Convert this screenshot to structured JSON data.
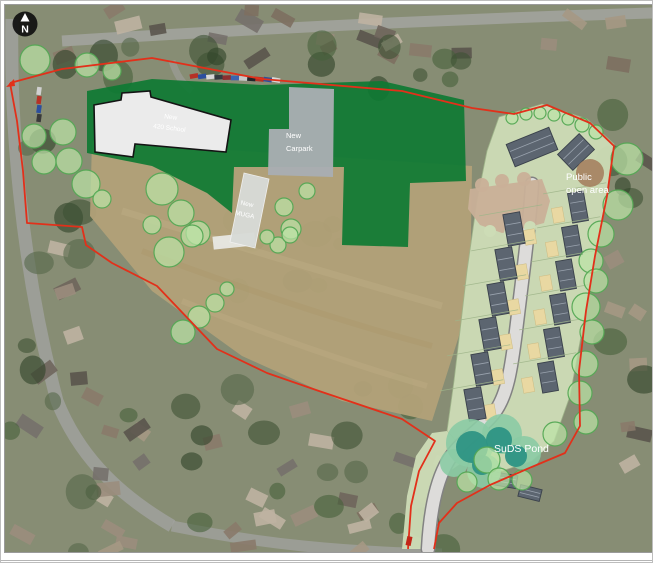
{
  "north_marker": {
    "label": "N"
  },
  "labels": [
    {
      "id": "school-label",
      "lines": [
        "New",
        "420 School"
      ]
    },
    {
      "id": "carpark-label",
      "lines": [
        "New",
        "Carpark"
      ]
    },
    {
      "id": "muga-label",
      "lines": [
        "New",
        "MUGA"
      ]
    },
    {
      "id": "open-area-label",
      "lines": [
        "Public",
        "open area"
      ]
    },
    {
      "id": "pond-label",
      "lines": [
        "SuDS Pond"
      ]
    }
  ],
  "colors": {
    "boundary_red": "#e2301a",
    "playing_field_green": "#0e7a33",
    "tree_fill": "#bce4a6",
    "tree_stroke": "#54a854",
    "housing_parcel": "#cddcb6",
    "road_fill": "#dddcda",
    "road_edge": "#828282",
    "court_tan": "#c9b098",
    "roof_grey": "#5c6570",
    "roof_line": "#9aa3ae",
    "garden_tan": "#e9d8a2",
    "pond_outer": "#8bcba4",
    "pond_inner": "#2e9484",
    "school_fill": "#ebebeb",
    "school_stroke": "#141414",
    "carpark_grey": "#a9aeb2",
    "muga_grey": "#d8dbd7",
    "open_area_patch": "#a5815f",
    "aerial_base": "#878d74",
    "field_tan": "#b2a178",
    "label_text": "#ffffff"
  },
  "site_plan": {
    "playing_field_polygon": "85,90 150,78 260,84 380,80 462,99 464,180 408,182 406,246 340,244 342,166 232,166 230,212 205,192 150,165 85,152",
    "school_polygon": "92,104 119,99 120,92 148,90 149,96 229,119 224,151 133,143 131,156 93,151",
    "carpark_polygon": "287,86 332,88 331,176 266,174 267,128 287,128",
    "muga_polygon": "242,172 267,178 253,247 228,241",
    "pavilion": [
      232,
      240,
      42,
      13,
      -6
    ],
    "field_polygon": "90,140 470,165 468,300 430,420 340,400 240,355 150,290 88,215",
    "housing_parcel_polygon": "497,116 540,103 585,118 612,143 605,192 592,260 580,330 568,395 552,440 530,460 500,470 468,456 445,430 452,380 458,330 465,270 475,200 485,150",
    "access_verge_polygon": "445,430 468,456 448,470 438,500 433,548 400,548 405,495 414,455 430,432",
    "road_path": "M 530 183 C 528 220 520 280 514 330 C 509 370 505 395 492 412 C 478 430 458 440 446 460 C 434 480 428 510 426 548",
    "court_polygon": "468,188 540,178 548,200 542,222 520,228 500,232 478,224 466,208",
    "court_bumps": [
      [
        480,
        184,
        7
      ],
      [
        500,
        180,
        7
      ],
      [
        522,
        178,
        7
      ]
    ],
    "court_punches": [
      [
        488,
        230,
        6
      ],
      [
        508,
        232,
        6
      ],
      [
        528,
        226,
        6
      ]
    ],
    "houses": [
      [
        530,
        146,
        46,
        24,
        -22
      ],
      [
        574,
        151,
        30,
        22,
        -44
      ],
      [
        512,
        228,
        17,
        32,
        -10
      ],
      [
        504,
        263,
        17,
        32,
        -10
      ],
      [
        496,
        298,
        17,
        32,
        -10
      ],
      [
        488,
        333,
        17,
        32,
        -10
      ],
      [
        480,
        368,
        17,
        32,
        -10
      ],
      [
        473,
        403,
        17,
        32,
        -10
      ],
      [
        576,
        206,
        16,
        30,
        -10
      ],
      [
        570,
        240,
        16,
        30,
        -10
      ],
      [
        564,
        274,
        16,
        30,
        -10
      ],
      [
        558,
        308,
        16,
        30,
        -10
      ],
      [
        552,
        342,
        16,
        30,
        -10
      ],
      [
        546,
        376,
        16,
        30,
        -10
      ],
      [
        502,
        479,
        26,
        13,
        10
      ],
      [
        528,
        492,
        22,
        12,
        14
      ]
    ],
    "gardens": [
      [
        528,
        236
      ],
      [
        520,
        271
      ],
      [
        512,
        306
      ],
      [
        504,
        341
      ],
      [
        496,
        376
      ],
      [
        488,
        411
      ],
      [
        556,
        214
      ],
      [
        550,
        248
      ],
      [
        544,
        282
      ],
      [
        538,
        316
      ],
      [
        532,
        350
      ],
      [
        526,
        384
      ]
    ],
    "trees": [
      [
        33,
        59,
        15
      ],
      [
        85,
        64,
        12
      ],
      [
        110,
        70,
        9
      ],
      [
        32,
        135,
        12
      ],
      [
        61,
        131,
        13
      ],
      [
        42,
        161,
        12
      ],
      [
        67,
        160,
        13
      ],
      [
        84,
        183,
        14
      ],
      [
        100,
        198,
        9
      ],
      [
        160,
        188,
        16
      ],
      [
        179,
        212,
        13
      ],
      [
        196,
        232,
        12
      ],
      [
        150,
        224,
        9
      ],
      [
        167,
        251,
        15
      ],
      [
        190,
        235,
        11
      ],
      [
        225,
        288,
        7
      ],
      [
        213,
        302,
        9
      ],
      [
        197,
        316,
        11
      ],
      [
        181,
        331,
        12
      ],
      [
        282,
        206,
        9
      ],
      [
        289,
        228,
        10
      ],
      [
        276,
        244,
        8
      ],
      [
        305,
        190,
        8
      ],
      [
        265,
        236,
        7
      ],
      [
        288,
        234,
        8
      ],
      [
        625,
        158,
        16
      ],
      [
        616,
        204,
        15
      ],
      [
        599,
        233,
        13
      ],
      [
        589,
        260,
        12
      ],
      [
        594,
        280,
        12
      ],
      [
        584,
        306,
        14
      ],
      [
        590,
        331,
        12
      ],
      [
        583,
        363,
        13
      ],
      [
        578,
        392,
        12
      ],
      [
        584,
        421,
        12
      ],
      [
        553,
        433,
        12
      ],
      [
        485,
        459,
        13
      ],
      [
        497,
        478,
        11
      ],
      [
        520,
        479,
        10
      ],
      [
        465,
        481,
        10
      ],
      [
        510,
        117,
        6
      ],
      [
        524,
        113,
        6
      ],
      [
        538,
        112,
        6
      ],
      [
        552,
        114,
        6
      ],
      [
        566,
        118,
        6
      ],
      [
        580,
        124,
        7
      ],
      [
        594,
        131,
        7
      ]
    ],
    "open_area_patch": [
      588,
      172,
      14
    ],
    "pond_outer_blobs": [
      [
        468,
        442,
        24
      ],
      [
        500,
        433,
        20
      ],
      [
        522,
        452,
        17
      ],
      [
        482,
        470,
        17
      ],
      [
        452,
        462,
        14
      ]
    ],
    "pond_inner_blobs": [
      [
        470,
        446,
        16
      ],
      [
        497,
        439,
        13
      ],
      [
        514,
        455,
        11
      ],
      [
        480,
        464,
        10
      ]
    ],
    "boundary_paths": [
      "M 8 82 L 60 68 L 150 57 L 260 78 L 400 90 L 470 107 L 512 113 L 545 104 L 588 122 L 612 145 L 605 195 L 593 255 L 584 310 L 577 370 L 578 425 L 563 452 L 525 468 L 488 484 L 455 502 L 437 522 L 432 548",
      "M 8 82 L 15 120 L 21 170 L 25 222 L 80 226 L 84 244 L 110 262 L 155 285 L 215 348 L 265 372 L 317 390 L 400 418 L 433 440 L 417 470 L 409 505 L 406 548"
    ]
  }
}
